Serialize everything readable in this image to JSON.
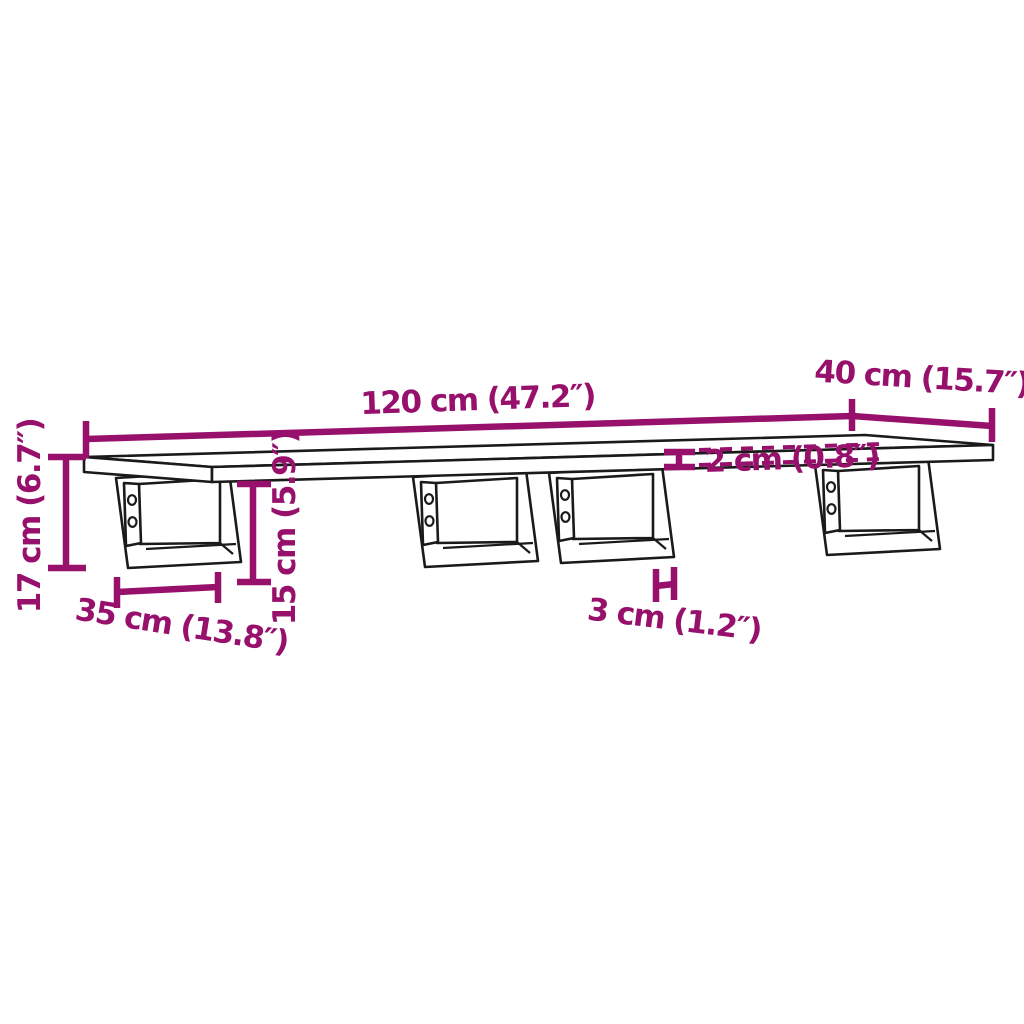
{
  "diagram": {
    "type": "furniture-dimension-diagram",
    "subject": "wall-mounted shelf board with four steel brackets",
    "colors": {
      "dimension_accent": "#97106c",
      "outline": "#1a1a1a",
      "background": "#ffffff"
    },
    "dimensions": {
      "length": "120 cm (47.2″)",
      "depth": "40 cm (15.7″)",
      "total_height": "17 cm (6.7″)",
      "bracket_height": "15 cm (5.9″)",
      "bracket_depth": "35 cm (13.8″)",
      "board_thickness": "2 cm (0.8″)",
      "bracket_edge_offset": "3 cm (1.2″)"
    }
  }
}
